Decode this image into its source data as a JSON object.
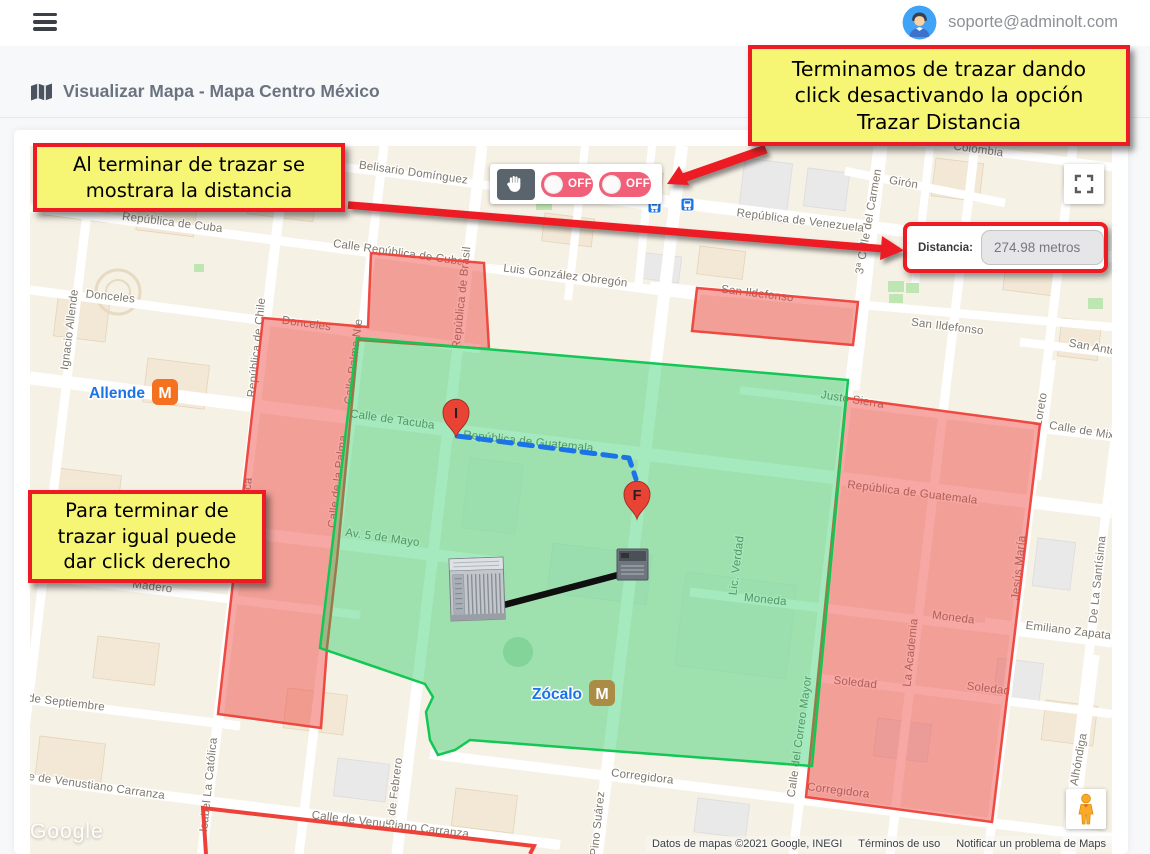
{
  "header": {
    "user_email": "soporte@adminolt.com"
  },
  "page": {
    "title": "Visualizar Mapa - Mapa Centro México"
  },
  "map_controls": {
    "toggle_1_label": "OFF",
    "toggle_2_label": "OFF"
  },
  "distance_panel": {
    "label": "Distancia:",
    "value": "274.98 metros"
  },
  "annotations": {
    "box_top_right": "Terminamos de trazar dando\nclick desactivando la opción\nTrazar Distancia",
    "box_left": "Al terminar de trazar se\nmostrara la distancia",
    "box_bottom_left": "Para terminar de\ntrazar igual puede\ndar click derecho"
  },
  "map": {
    "markers": [
      {
        "label": "I"
      },
      {
        "label": "F"
      }
    ],
    "stations": [
      {
        "name": "Allende"
      },
      {
        "name": "Zócalo"
      }
    ],
    "attribution": {
      "watermark": "Google",
      "data": "Datos de mapas ©2021 Google, INEGI",
      "terms": "Términos de uso",
      "report": "Notificar un problema de Maps"
    },
    "colors": {
      "annotation_red": "#ED1C24",
      "annotation_yellow": "#F7F574",
      "polygon_red": "#ED423A",
      "polygon_green": "#12C754",
      "route_blue": "#1A73E8",
      "toggle_pink": "#F15F78",
      "marker_red": "#E94335",
      "metro_orange": "#F4711F",
      "metro_gold": "#AA8C44",
      "transit_blue": "#1A73E8"
    },
    "street_labels": [
      {
        "t": "Belisario Domínguez",
        "x": 413,
        "y": 176,
        "r": 8
      },
      {
        "t": "República de Venezuela",
        "x": 800,
        "y": 224,
        "r": 7
      },
      {
        "t": "Girón",
        "x": 903,
        "y": 186,
        "r": 10,
        "s": 13
      },
      {
        "t": "Colombia",
        "x": 978,
        "y": 153,
        "r": 8
      },
      {
        "t": "República de Cuba",
        "x": 172,
        "y": 226,
        "r": 7
      },
      {
        "t": "Calle República de Cuba",
        "x": 398,
        "y": 256,
        "r": 8
      },
      {
        "t": "Luis González Obregón",
        "x": 565,
        "y": 279,
        "r": 7
      },
      {
        "t": "San Ildefonso",
        "x": 757,
        "y": 297,
        "r": 7
      },
      {
        "t": "San Ildefonso",
        "x": 947,
        "y": 330,
        "r": 7
      },
      {
        "t": "San Antonio",
        "x": 1100,
        "y": 352,
        "r": 10
      },
      {
        "t": "Donceles",
        "x": 110,
        "y": 300,
        "r": 6
      },
      {
        "t": "Donceles",
        "x": 306,
        "y": 327,
        "r": 8
      },
      {
        "t": "Ignacio Allende",
        "x": 73,
        "y": 330,
        "r": -83
      },
      {
        "t": "República de Chile",
        "x": 260,
        "y": 348,
        "r": -84
      },
      {
        "t": "Isabel La Católica",
        "x": 247,
        "y": 525,
        "r": -84
      },
      {
        "t": "República de Brasil",
        "x": 465,
        "y": 298,
        "r": -84
      },
      {
        "t": "Calle Palma Nte",
        "x": 357,
        "y": 362,
        "r": -83
      },
      {
        "t": "Calle de la Palma",
        "x": 341,
        "y": 482,
        "r": -83
      },
      {
        "t": "Calle de Tacuba",
        "x": 392,
        "y": 423,
        "r": 8,
        "s": 13.5
      },
      {
        "t": "República de Guatemala",
        "x": 528,
        "y": 445,
        "r": 6
      },
      {
        "t": "República de Guatemala",
        "x": 912,
        "y": 496,
        "r": 7
      },
      {
        "t": "Justo Sierra",
        "x": 852,
        "y": 403,
        "r": 9
      },
      {
        "t": "Calle de Mixcalco",
        "x": 1095,
        "y": 436,
        "r": 9
      },
      {
        "t": "Loreto",
        "x": 1044,
        "y": 410,
        "r": -80
      },
      {
        "t": "Lic. Verdad",
        "x": 740,
        "y": 566,
        "r": -83
      },
      {
        "t": "Moneda",
        "x": 765,
        "y": 603,
        "r": 6
      },
      {
        "t": "Moneda",
        "x": 953,
        "y": 621,
        "r": 7
      },
      {
        "t": "La Academia",
        "x": 914,
        "y": 653,
        "r": -84
      },
      {
        "t": "Soledad",
        "x": 855,
        "y": 686,
        "r": 6
      },
      {
        "t": "Soledad",
        "x": 988,
        "y": 692,
        "r": 7
      },
      {
        "t": "Emiliano Zapata",
        "x": 1068,
        "y": 634,
        "r": 7
      },
      {
        "t": "Jesús María",
        "x": 1022,
        "y": 568,
        "r": -84
      },
      {
        "t": "De La Santísima",
        "x": 1101,
        "y": 580,
        "r": -84
      },
      {
        "t": "3ª Calle del Carmen",
        "x": 872,
        "y": 222,
        "r": -80
      },
      {
        "t": "de Mayo",
        "x": 112,
        "y": 518,
        "r": 7
      },
      {
        "t": "Av. 5 de Mayo",
        "x": 382,
        "y": 541,
        "r": 8,
        "s": 13.5
      },
      {
        "t": "Madero",
        "x": 152,
        "y": 590,
        "r": 7
      },
      {
        "t": "de Septiembre",
        "x": 66,
        "y": 706,
        "r": 7
      },
      {
        "t": "Calle de Venustiano Carranza",
        "x": 86,
        "y": 788,
        "r": 8
      },
      {
        "t": "Calle de Venustiano Carranza",
        "x": 390,
        "y": 828,
        "r": 7
      },
      {
        "t": "Isabel La Católica",
        "x": 212,
        "y": 785,
        "r": -84
      },
      {
        "t": "5 de Febrero",
        "x": 398,
        "y": 792,
        "r": -83
      },
      {
        "t": "Pino Suárez",
        "x": 601,
        "y": 824,
        "r": -84,
        "s": 13.5
      },
      {
        "t": "Corregidora",
        "x": 642,
        "y": 780,
        "r": 7
      },
      {
        "t": "Corregidora",
        "x": 838,
        "y": 794,
        "r": 7
      },
      {
        "t": "Calle del Correo Mayor",
        "x": 803,
        "y": 737,
        "r": -82
      },
      {
        "t": "Alhóndiga",
        "x": 1082,
        "y": 760,
        "r": -80
      }
    ]
  }
}
